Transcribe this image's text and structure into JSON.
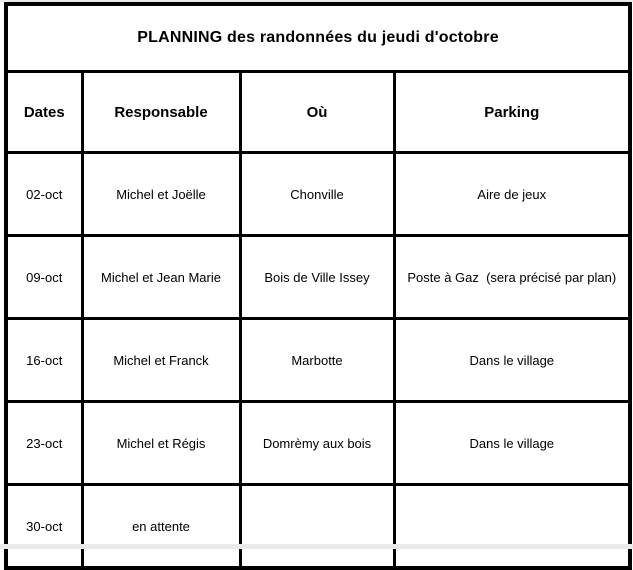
{
  "title": "PLANNING des randonnées du jeudi d'octobre",
  "table": {
    "columns": [
      "Dates",
      "Responsable",
      "Où",
      "Parking"
    ],
    "rows": [
      [
        "02-oct",
        "Michel et Joëlle",
        "Chonville",
        "Aire de jeux"
      ],
      [
        "09-oct",
        "Michel et Jean Marie",
        "Bois de Ville Issey",
        "Poste à Gaz  (sera précisé par plan)"
      ],
      [
        "16-oct",
        "Michel et Franck",
        "Marbotte",
        "Dans le village"
      ],
      [
        "23-oct",
        "Michel et Régis",
        "Domrèmy aux bois",
        "Dans le village"
      ],
      [
        "30-oct",
        "en attente",
        "",
        ""
      ]
    ]
  }
}
